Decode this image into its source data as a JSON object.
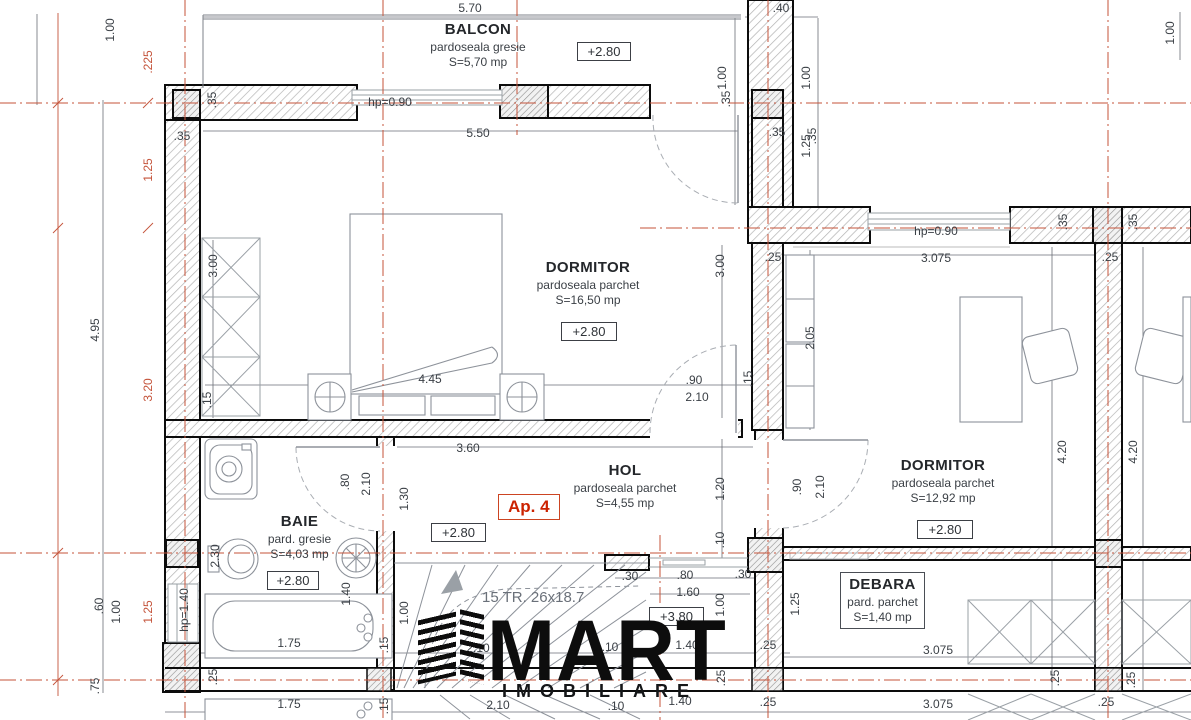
{
  "title": "Floor plan apartment 4",
  "apartment_label": "Ap. 4",
  "colors": {
    "axis_red": "#c4533a",
    "apartment_red": "#cc2200",
    "dim_text": "#3b4046",
    "wall_black": "#0c0c0c"
  },
  "rooms": [
    {
      "name": "BALCON",
      "floor": "pardoseala gresie",
      "area": "S=5,70 mp",
      "level": "+2.80"
    },
    {
      "name": "DORMITOR",
      "floor": "pardoseala parchet",
      "area": "S=16,50 mp",
      "level": "+2.80"
    },
    {
      "name": "HOL",
      "floor": "pardoseala parchet",
      "area": "S=4,55 mp",
      "level": "+2.80"
    },
    {
      "name": "BAIE",
      "floor": "pard. gresie",
      "area": "S=4,03 mp",
      "level": "+2.80"
    },
    {
      "name": "DORMITOR",
      "floor": "pardoseala parchet",
      "area": "S=12,92 mp",
      "level": "+2.80"
    },
    {
      "name": "DEBARA",
      "floor": "pard. parchet",
      "area": "S=1,40 mp"
    }
  ],
  "stairs": {
    "label": "15 TR. 26x18.7",
    "landing_level": "+3.80"
  },
  "logo": {
    "name": "MART",
    "sub": "IMOBILIARE"
  },
  "dimensions": [
    {
      "t": "5.70",
      "x": 470,
      "y": 8
    },
    {
      "t": "1.00",
      "x": 722,
      "y": 78,
      "v": 1
    },
    {
      "t": ".40",
      "x": 781,
      "y": 8
    },
    {
      "t": "1.00",
      "x": 806,
      "y": 78,
      "v": 1
    },
    {
      "t": "1.00",
      "x": 1170,
      "y": 33,
      "v": 1
    },
    {
      "t": "1.00",
      "x": 110,
      "y": 30,
      "v": 1
    },
    {
      "t": ".225",
      "x": 148,
      "y": 62,
      "v": 1,
      "r": 1
    },
    {
      "t": "1.25",
      "x": 148,
      "y": 170,
      "v": 1,
      "r": 1
    },
    {
      "t": "4.95",
      "x": 95,
      "y": 330,
      "v": 1
    },
    {
      "t": "3.20",
      "x": 148,
      "y": 390,
      "v": 1,
      "r": 1
    },
    {
      "t": "1.25",
      "x": 148,
      "y": 612,
      "v": 1,
      "r": 1
    },
    {
      "t": ".60",
      "x": 99,
      "y": 606,
      "v": 1
    },
    {
      "t": "1.00",
      "x": 116,
      "y": 612,
      "v": 1
    },
    {
      "t": ".75",
      "x": 95,
      "y": 686,
      "v": 1
    },
    {
      "t": "hp=0.90",
      "x": 390,
      "y": 102
    },
    {
      "t": "5.50",
      "x": 478,
      "y": 133
    },
    {
      "t": ".35",
      "x": 182,
      "y": 136
    },
    {
      "t": ".35",
      "x": 212,
      "y": 100,
      "v": 1
    },
    {
      "t": ".35",
      "x": 726,
      "y": 99,
      "v": 1
    },
    {
      "t": ".35",
      "x": 777,
      "y": 132
    },
    {
      "t": ".35",
      "x": 812,
      "y": 136,
      "v": 1
    },
    {
      "t": "1.25",
      "x": 806,
      "y": 146,
      "v": 1
    },
    {
      "t": "hp=0.90",
      "x": 936,
      "y": 231
    },
    {
      "t": ".25",
      "x": 773,
      "y": 257
    },
    {
      "t": "3.075",
      "x": 936,
      "y": 258
    },
    {
      "t": ".25",
      "x": 1110,
      "y": 257
    },
    {
      "t": ".35",
      "x": 1063,
      "y": 222,
      "v": 1
    },
    {
      "t": ".35",
      "x": 1133,
      "y": 222,
      "v": 1
    },
    {
      "t": "2.05",
      "x": 810,
      "y": 338,
      "v": 1
    },
    {
      "t": "4.20",
      "x": 1062,
      "y": 452,
      "v": 1
    },
    {
      "t": "4.20",
      "x": 1133,
      "y": 452,
      "v": 1
    },
    {
      "t": "3.00",
      "x": 213,
      "y": 266,
      "v": 1
    },
    {
      "t": "3.00",
      "x": 720,
      "y": 266,
      "v": 1
    },
    {
      "t": "4.45",
      "x": 430,
      "y": 379
    },
    {
      "t": ".15",
      "x": 207,
      "y": 400,
      "v": 1
    },
    {
      "t": ".90",
      "x": 694,
      "y": 380
    },
    {
      "t": "2.10",
      "x": 697,
      "y": 397
    },
    {
      "t": ".15",
      "x": 748,
      "y": 379,
      "v": 1
    },
    {
      "t": "3.60",
      "x": 468,
      "y": 448
    },
    {
      "t": "1.20",
      "x": 720,
      "y": 489,
      "v": 1
    },
    {
      "t": ".10",
      "x": 720,
      "y": 540,
      "v": 1
    },
    {
      "t": ".90",
      "x": 797,
      "y": 487,
      "v": 1
    },
    {
      "t": "2.10",
      "x": 820,
      "y": 487,
      "v": 1
    },
    {
      "t": "2.30",
      "x": 215,
      "y": 556,
      "v": 1
    },
    {
      "t": ".80",
      "x": 345,
      "y": 482,
      "v": 1
    },
    {
      "t": "2.10",
      "x": 366,
      "y": 484,
      "v": 1
    },
    {
      "t": "1.30",
      "x": 404,
      "y": 499,
      "v": 1
    },
    {
      "t": "1.40",
      "x": 346,
      "y": 594,
      "v": 1
    },
    {
      "t": "1.00",
      "x": 404,
      "y": 613,
      "v": 1
    },
    {
      "t": "hp=1.40",
      "x": 184,
      "y": 610,
      "v": 1
    },
    {
      "t": "1.75",
      "x": 289,
      "y": 643
    },
    {
      "t": ".15",
      "x": 384,
      "y": 645,
      "v": 1
    },
    {
      "t": "2.10",
      "x": 478,
      "y": 648
    },
    {
      "t": ".10",
      "x": 610,
      "y": 647
    },
    {
      "t": "1.40",
      "x": 687,
      "y": 645
    },
    {
      "t": ".25",
      "x": 768,
      "y": 645
    },
    {
      "t": ".30",
      "x": 630,
      "y": 576
    },
    {
      "t": ".80",
      "x": 685,
      "y": 575
    },
    {
      "t": ".30",
      "x": 743,
      "y": 574
    },
    {
      "t": "1.60",
      "x": 688,
      "y": 592
    },
    {
      "t": "1.00",
      "x": 720,
      "y": 605,
      "v": 1
    },
    {
      "t": "1.25",
      "x": 795,
      "y": 604,
      "v": 1
    },
    {
      "t": "3.075",
      "x": 938,
      "y": 650
    },
    {
      "t": ".25",
      "x": 213,
      "y": 677,
      "v": 1
    },
    {
      "t": ".25",
      "x": 721,
      "y": 678,
      "v": 1
    },
    {
      "t": ".25",
      "x": 1055,
      "y": 678,
      "v": 1
    },
    {
      "t": ".25",
      "x": 1131,
      "y": 680,
      "v": 1
    },
    {
      "t": "1.75",
      "x": 289,
      "y": 704
    },
    {
      "t": ".15",
      "x": 384,
      "y": 706,
      "v": 1
    },
    {
      "t": "2.10",
      "x": 498,
      "y": 705
    },
    {
      "t": ".10",
      "x": 616,
      "y": 706
    },
    {
      "t": "1.40",
      "x": 680,
      "y": 701
    },
    {
      "t": ".25",
      "x": 768,
      "y": 702
    },
    {
      "t": "3.075",
      "x": 938,
      "y": 704
    },
    {
      "t": ".25",
      "x": 1106,
      "y": 702
    }
  ]
}
